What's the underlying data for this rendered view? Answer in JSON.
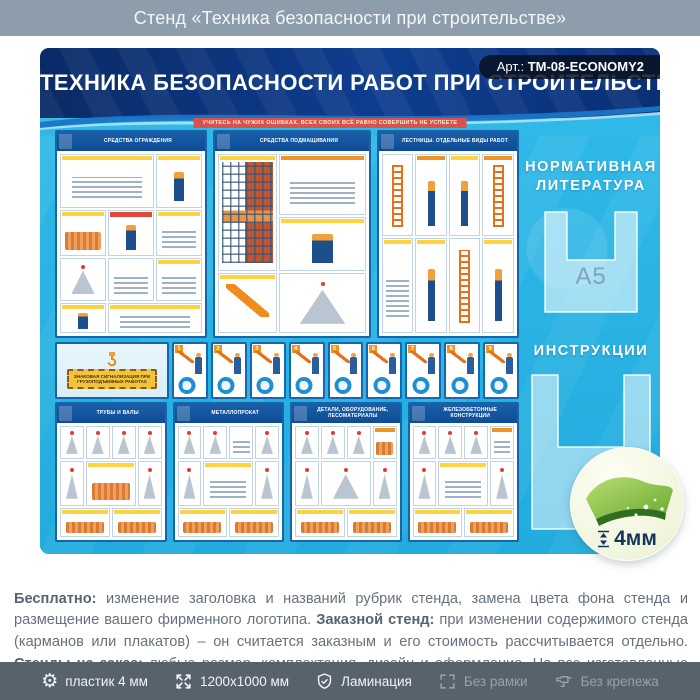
{
  "page": {
    "title": "Стенд «Техника безопасности при строительстве»"
  },
  "stand": {
    "art_label": "Арт.:",
    "art_code": "ТМ-08-ECONOMY2",
    "title": "ТЕХНИКА БЕЗОПАСНОСТИ РАБОТ ПРИ СТРОИТЕЛЬСТВЕ",
    "motto": "УЧИТЕСЬ НА ЧУЖИХ ОШИБКАХ, ВСЕХ СВОИХ ВСЁ РАВНО СОВЕРШИТЬ НЕ УСПЕЕТЕ",
    "posters_top": [
      {
        "title": "СРЕДСТВА ОГРАЖДЕНИЯ"
      },
      {
        "title": "СРЕДСТВА ПОДМАЩИВАНИЯ"
      },
      {
        "title": "ЛЕСТНИЦЫ. ОТДЕЛЬНЫЕ ВИДЫ РАБОТ"
      }
    ],
    "signal_strip": {
      "sign_text": "ЗНАКОВАЯ СИГНАЛИЗАЦИЯ ПРИ ГРУЗОПОДЪЕМНЫХ РАБОТАХ",
      "panel_numbers": [
        "1",
        "2",
        "3",
        "4",
        "5",
        "6",
        "7",
        "8",
        "9"
      ]
    },
    "posters_bottom": [
      {
        "title": "ТРУБЫ И ВАЛЫ"
      },
      {
        "title": "МЕТАЛЛОПРОКАТ"
      },
      {
        "title": "ДЕТАЛИ, ОБОРУДОВАНИЕ, ЛЕСОМАТЕРИАЛЫ"
      },
      {
        "title": "ЖЕЛЕЗОБЕТОННЫЕ КОНСТРУКЦИИ"
      }
    ],
    "right_column": {
      "literature_heading": "НОРМАТИВНАЯ ЛИТЕРАТУРА",
      "pocket_label": "А5",
      "instructions_heading": "ИНСТРУКЦИИ"
    },
    "thickness_value": "4мм"
  },
  "description": {
    "segments": [
      {
        "text": "Бесплатно:",
        "bold": true
      },
      {
        "text": " изменение заголовка и названий рубрик стенда, замена цвета фона стенда и размещение вашего фирменного логотипа. ",
        "bold": false
      },
      {
        "text": "Заказной стенд:",
        "bold": true
      },
      {
        "text": " при изменении содержимого стенда (карманов или плакатов) – он считается заказным и его стоимость рассчитывается отдельно. ",
        "bold": false
      },
      {
        "text": "Стенды на заказ:",
        "bold": true
      },
      {
        "text": " любые размер, комплектация, дизайн и оформление. На все изготовленные стенды даем 2 года гарантии. Выгодно, эстетично и надежно!",
        "bold": false
      }
    ]
  },
  "footer": {
    "items": [
      {
        "icon": "gear-icon",
        "label": "пластик 4 мм",
        "active": true
      },
      {
        "icon": "dimensions-icon",
        "label": "1200x1000 мм",
        "active": true
      },
      {
        "icon": "shield-check-icon",
        "label": "Ламинация",
        "active": true
      },
      {
        "icon": "frame-icon",
        "label": "Без рамки",
        "active": false
      },
      {
        "icon": "drill-icon",
        "label": "Без крепежа",
        "active": false
      }
    ]
  },
  "colors": {
    "top_bar": "#8e9dab",
    "stand_background": "#29b4e5",
    "header_navy": "#0e3d8f",
    "poster_blue": "#1565ad",
    "accent_orange": "#f0941e",
    "accent_yellow": "#ffd23f",
    "motto_red": "#d9534a",
    "badge_green": "#8dc63f",
    "footer_bar": "#58626c"
  }
}
